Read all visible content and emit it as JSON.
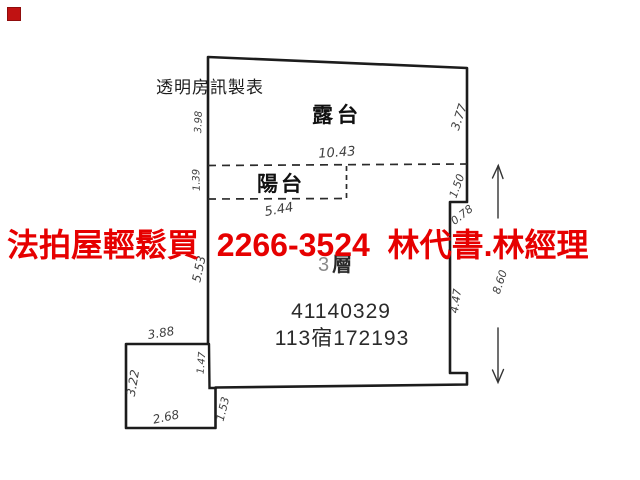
{
  "overlay": {
    "marker_color": "#c01212",
    "banner_text": "法拍屋輕鬆買  2266-3524  林代書.林經理",
    "banner_color": "#e60000"
  },
  "plan": {
    "maker_label": "透明房訊製表",
    "terrace_label": "露台",
    "balcony_label": "陽台",
    "floor_number": "3",
    "floor_word": "層",
    "registry_number": "41140329",
    "registry_code": "113宿172193",
    "line_color": "#1c1c1c",
    "dims": {
      "terrace_width": "10.43",
      "balcony_width": "5.44",
      "left_upper": "3.98",
      "left_balcony": "1.39",
      "left_middle": "5.53",
      "left_lower": "1.47",
      "right_upper": "3.77",
      "right_middle": "1.50",
      "right_step": "0.78",
      "right_lower": "4.47",
      "overall_height": "8.60",
      "annex_top": "3.88",
      "annex_left": "3.22",
      "annex_bottom": "2.68",
      "annex_right": "1.53"
    }
  }
}
